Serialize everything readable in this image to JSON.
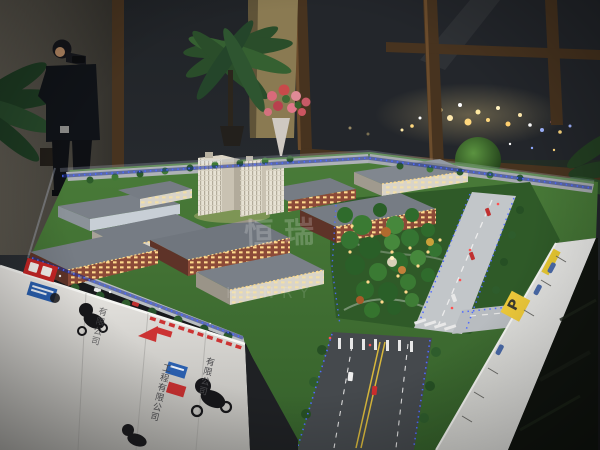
{
  "watermark": {
    "cn": "恒瑞",
    "en": "HENRY"
  },
  "table_skirt": {
    "company_text_1": "工程有限公司",
    "company_text_2": "有限公司",
    "parking_label": "P"
  },
  "icons": [
    "red-brand-logo",
    "blue-brand-logo",
    "panda-mascot-graphic",
    "red-arrow-graphic",
    "parking-sign",
    "hazard-stripe"
  ],
  "colors": {
    "lawn_green": "#3c6a30",
    "park_green": "#2f5a28",
    "brick_red": "#8c4a38",
    "roof_gray": "#767c84",
    "tower_cream": "#e7e2d4",
    "led_blue": "#4f6bff",
    "window_glow": "#ffd98c",
    "night_light_gold": "#ffdf8f",
    "skirt_white": "#e6e5e1",
    "logo_red": "#c42525",
    "logo_blue": "#2a5fae",
    "parking_yellow": "#edc93a",
    "floor_dark": "#10140f",
    "mullion_brown": "#47331f"
  }
}
